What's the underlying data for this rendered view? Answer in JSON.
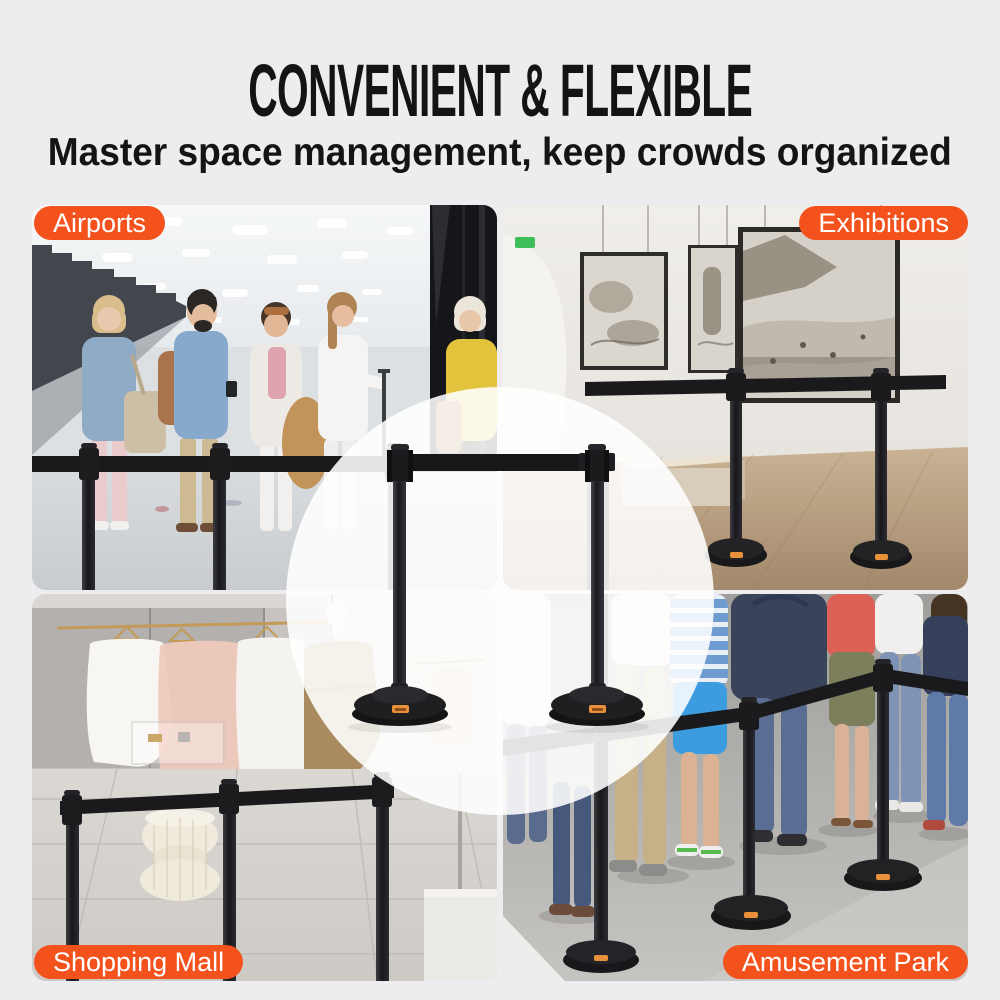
{
  "page": {
    "width": 1000,
    "height": 1000,
    "background": "#EDEDEF"
  },
  "header": {
    "title": "CONVENIENT & FLEXIBLE",
    "subtitle": "Master space management, keep crowds organized",
    "text_color": "#141414"
  },
  "colors": {
    "accent_orange": "#F4521D",
    "label_text": "#FFFFFF",
    "belt_black": "#17171A",
    "post_black": "#232326",
    "circle_overlay": "rgba(255,255,255,0.88)",
    "base_logo_chip": "#E8913A"
  },
  "scenes": [
    {
      "id": "airports",
      "label": "Airports",
      "label_position": "top-left"
    },
    {
      "id": "exhibitions",
      "label": "Exhibitions",
      "label_position": "top-right"
    },
    {
      "id": "shopping-mall",
      "label": "Shopping Mall",
      "label_position": "bottom-left"
    },
    {
      "id": "amusement-park",
      "label": "Amusement Park",
      "label_position": "bottom-right"
    }
  ],
  "center_product": {
    "item": "retractable-belt-stanchions",
    "stanchions_visible": 2,
    "belt_color": "black",
    "post_color": "black"
  }
}
